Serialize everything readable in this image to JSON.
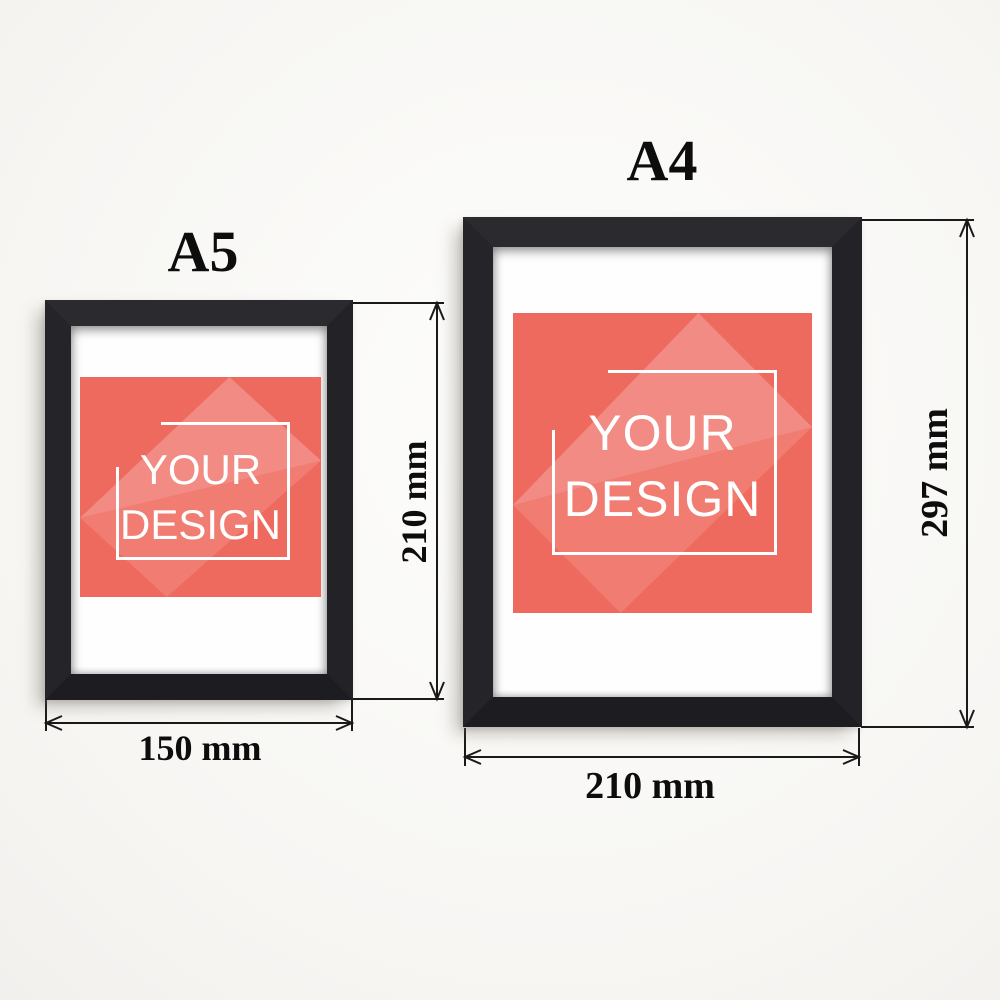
{
  "frames": [
    {
      "id": "a5",
      "size_label": "A5",
      "width_label": "150 mm",
      "height_label": "210 mm",
      "artwork": {
        "line1": "YOUR",
        "line2": "DESIGN"
      }
    },
    {
      "id": "a4",
      "size_label": "A4",
      "width_label": "210 mm",
      "height_label": "297 mm",
      "artwork": {
        "line1": "YOUR",
        "line2": "DESIGN"
      }
    }
  ],
  "colors": {
    "artwork_red": "#ee695e",
    "artwork_text": "#ffffff",
    "frame_black": "#232327",
    "line_black": "#1a1a1a",
    "background_white": "#fdfdfc"
  }
}
